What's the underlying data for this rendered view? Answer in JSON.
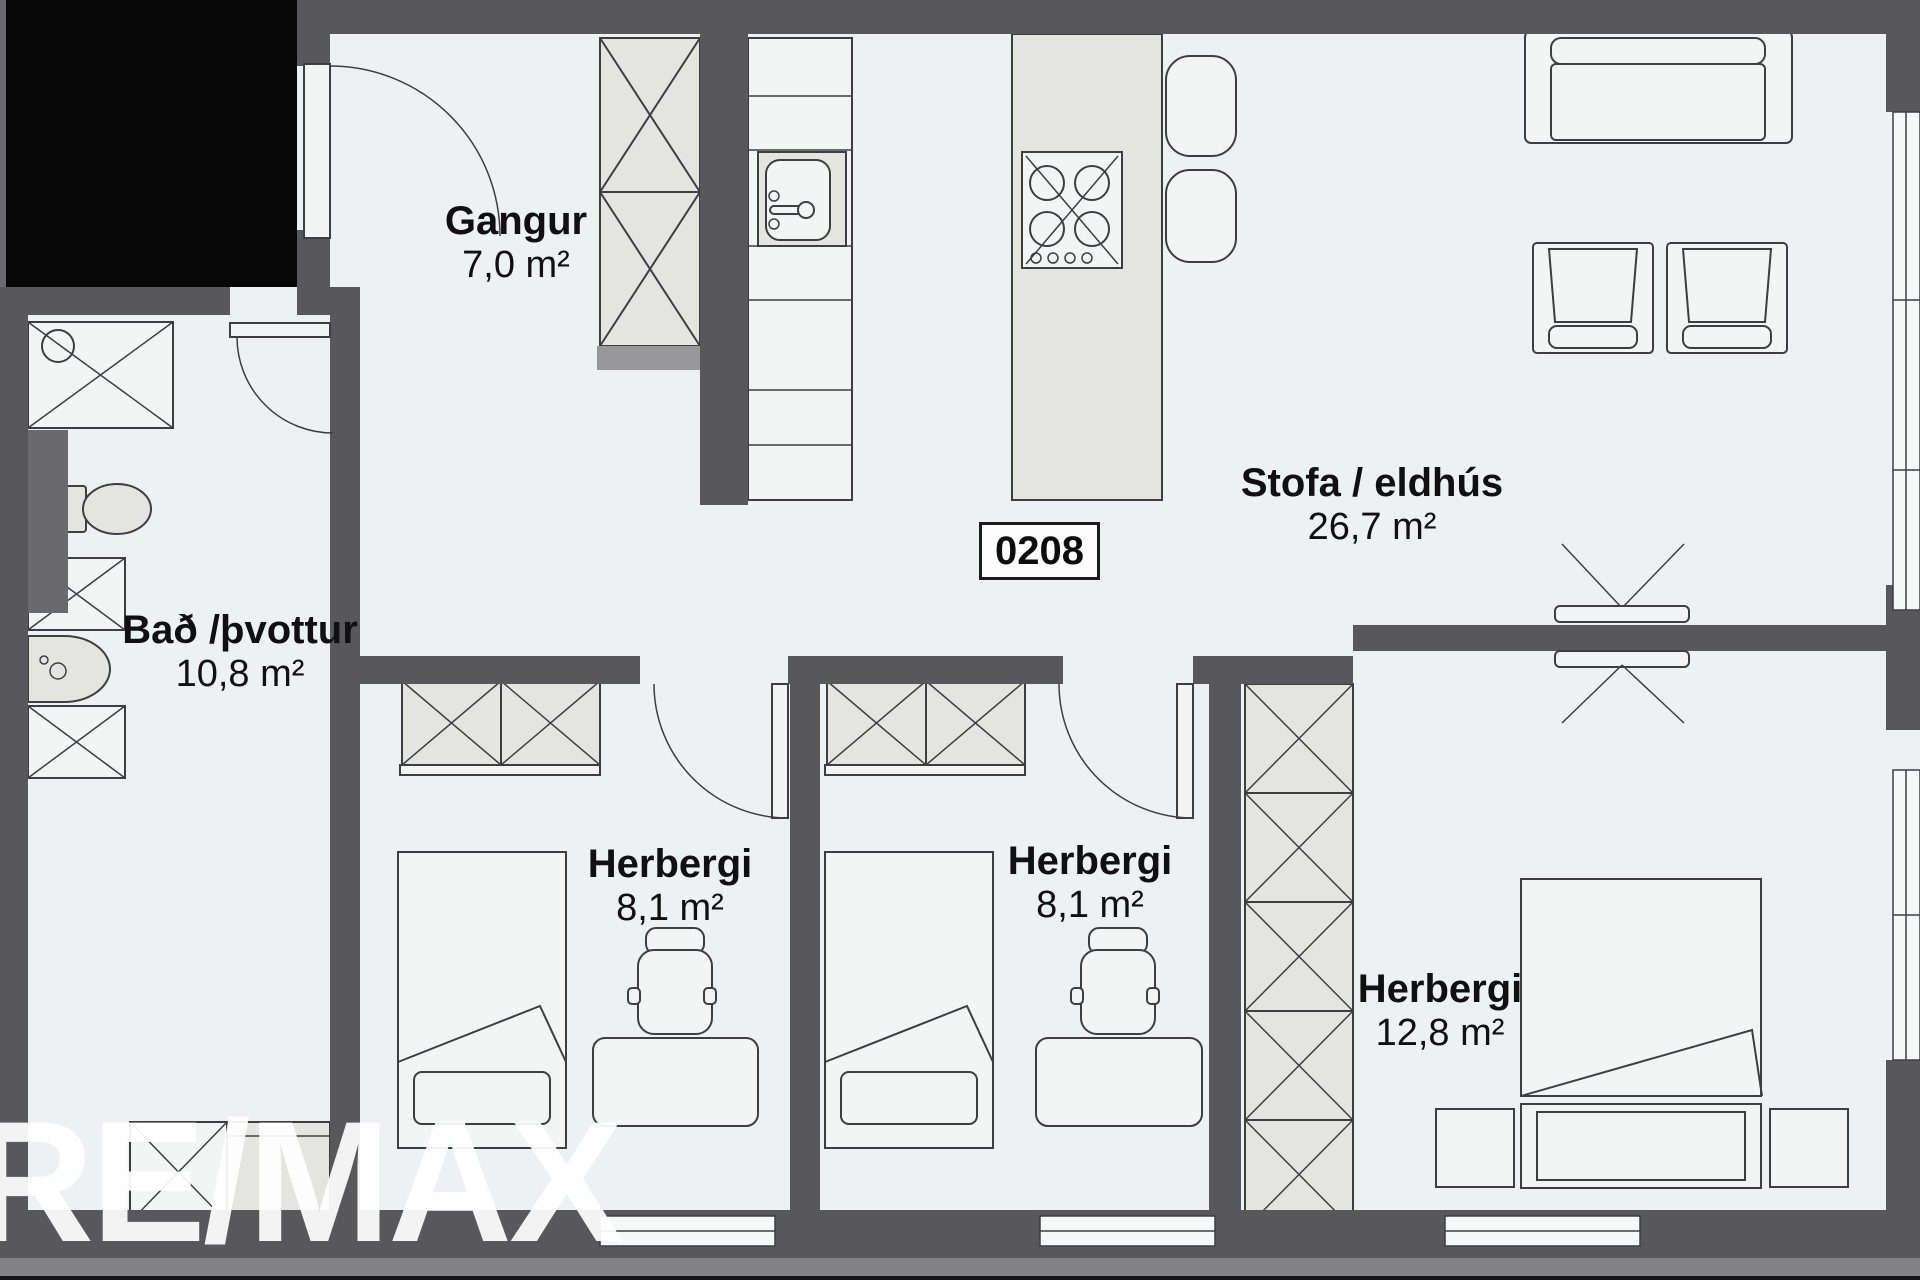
{
  "plan": {
    "unit_number": "0208",
    "watermark": "RE/MAX",
    "rooms": [
      {
        "name": "Gangur",
        "area": "7,0 m²"
      },
      {
        "name": "Stofa / eldhús",
        "area": "26,7 m²"
      },
      {
        "name": "Bað /þvottur",
        "area": "10,8 m²"
      },
      {
        "name": "Herbergi",
        "area": "8,1 m²"
      },
      {
        "name": "Herbergi",
        "area": "8,1 m²"
      },
      {
        "name": "Herbergi",
        "area": "12,8 m²"
      }
    ],
    "colors": {
      "background": "#eef1f2",
      "wall": "#58585a",
      "wall_light": "#828284",
      "furniture_gray": "#e4e5e1",
      "furniture_white": "#f3f5f5",
      "outline": "#3e3e40",
      "black_area": "#070707",
      "watermark": "#ffffff",
      "label_text": "#101010"
    }
  }
}
